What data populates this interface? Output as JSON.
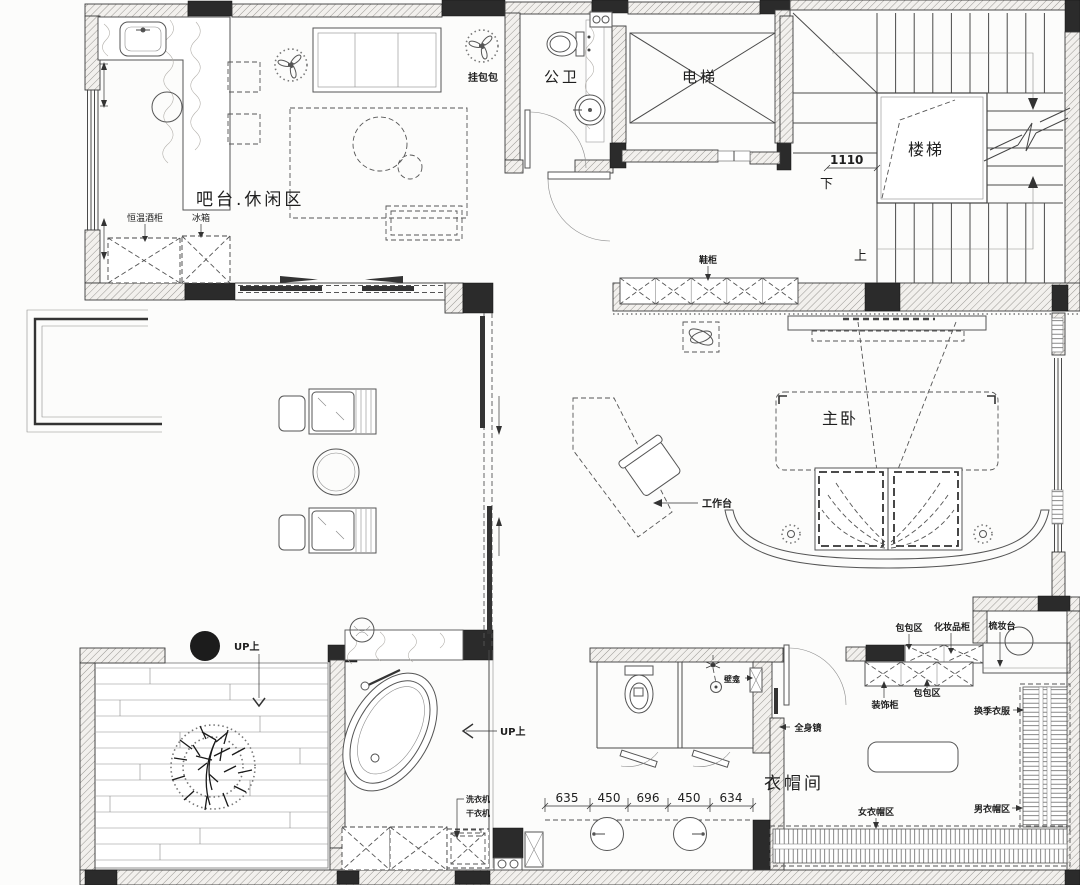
{
  "rooms": {
    "bar": "吧台.休闲区",
    "public_wc": "公卫",
    "elevator": "电梯",
    "stairs": "楼梯",
    "master": "主卧",
    "cloak": "衣帽间"
  },
  "labels": {
    "hang_bags": "挂包包",
    "wine_cabinet": "恒温酒柜",
    "fridge": "冰箱",
    "shoe_cabinet": "鞋柜",
    "workdesk": "工作台",
    "bag_area_top": "包包区",
    "cosmetics_cabinet": "化妆品柜",
    "dressing_table": "梳妆台",
    "bag_area_mid": "包包区",
    "decor_cabinet": "装饰柜",
    "seasonal_clothes": "换季衣服",
    "full_mirror": "全身镜",
    "women_area": "女衣帽区",
    "men_area": "男衣帽区",
    "washer": "洗衣机",
    "dryer": "干衣机",
    "niche": "壁龛",
    "up_terrace": "UP上",
    "up_bath": "UP上",
    "stair_up": "上",
    "stair_down": "下",
    "stair_dim": "1110"
  },
  "dims": [
    "635",
    "450",
    "696",
    "450",
    "634"
  ]
}
